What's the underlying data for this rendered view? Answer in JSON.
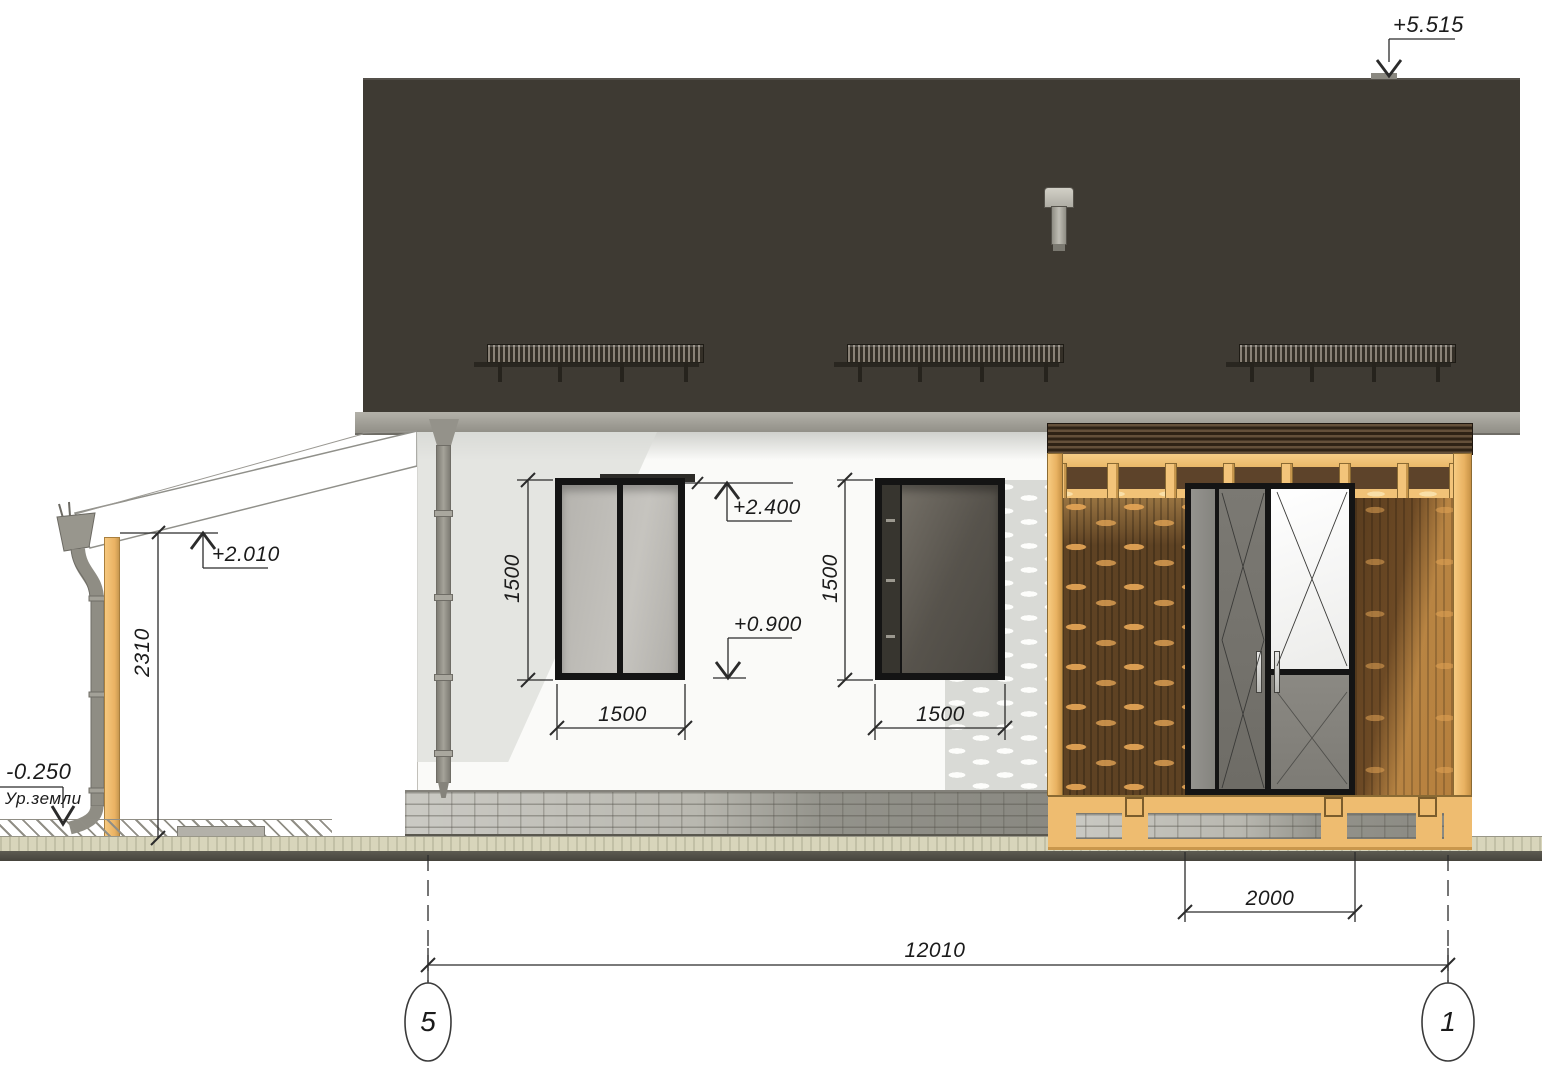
{
  "drawing": {
    "kind": "house facade elevation"
  },
  "levels": {
    "ridge": "+5.515",
    "head": "+2.400",
    "sill": "+0.900",
    "porch": "+2.010",
    "ground": "-0.250",
    "ground_label": "Ур.земли"
  },
  "dims": {
    "porch_height": "2310",
    "win1_h": "1500",
    "win1_w": "1500",
    "win2_h": "1500",
    "win2_w": "1500",
    "door_w": "2000",
    "total": "12010"
  },
  "grid": {
    "left": "5",
    "right": "1"
  },
  "colors": {
    "roof": "#3E3A33",
    "fascia": "#A6A39B",
    "wall": "#FAFAF8",
    "shadow": "#DCDDD9",
    "frame": "#141414",
    "timber": "#F0C178",
    "wood-dark": "#5E4223",
    "wood-light": "#A87A3E",
    "plinth": "#B9B8B0",
    "soil": "#D8D5BB",
    "ground": "#55534A",
    "line": "#2B2B2B"
  }
}
